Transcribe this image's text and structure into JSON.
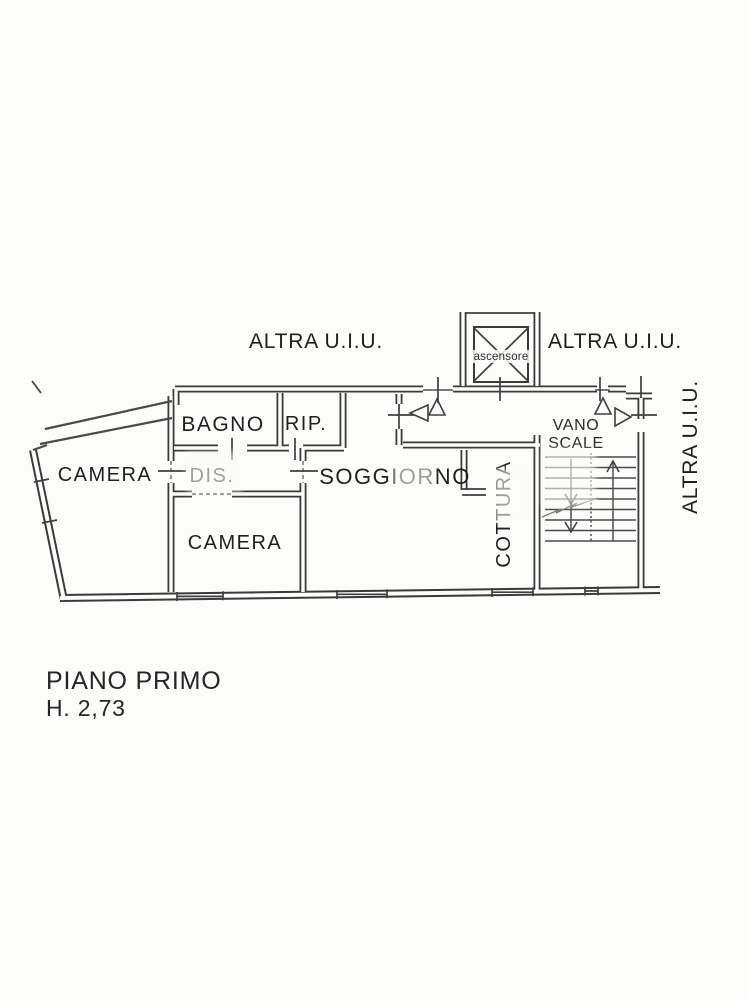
{
  "plan": {
    "external_labels": {
      "top_left": "ALTRA U.I.U.",
      "top_right": "ALTRA U.I.U.",
      "right_side": "ALTRA U.I.U."
    },
    "elevator_label": "ascensore",
    "stairwell": {
      "label_line1": "VANO",
      "label_line2": "SCALE"
    },
    "rooms": {
      "camera_left": "CAMERA",
      "bagno": "BAGNO",
      "rip": "RIP.",
      "dis": "DIS.",
      "camera_center": "CAMERA",
      "soggiorno": "SOGGIORNO",
      "cottura": "COTTURA"
    }
  },
  "caption": {
    "floor_title": "PIANO PRIMO",
    "floor_height": "H. 2,73"
  },
  "colors": {
    "ink": "#3a3a3a",
    "paper": "#fcfcfa",
    "faded_ink": "#9b9b9b"
  }
}
